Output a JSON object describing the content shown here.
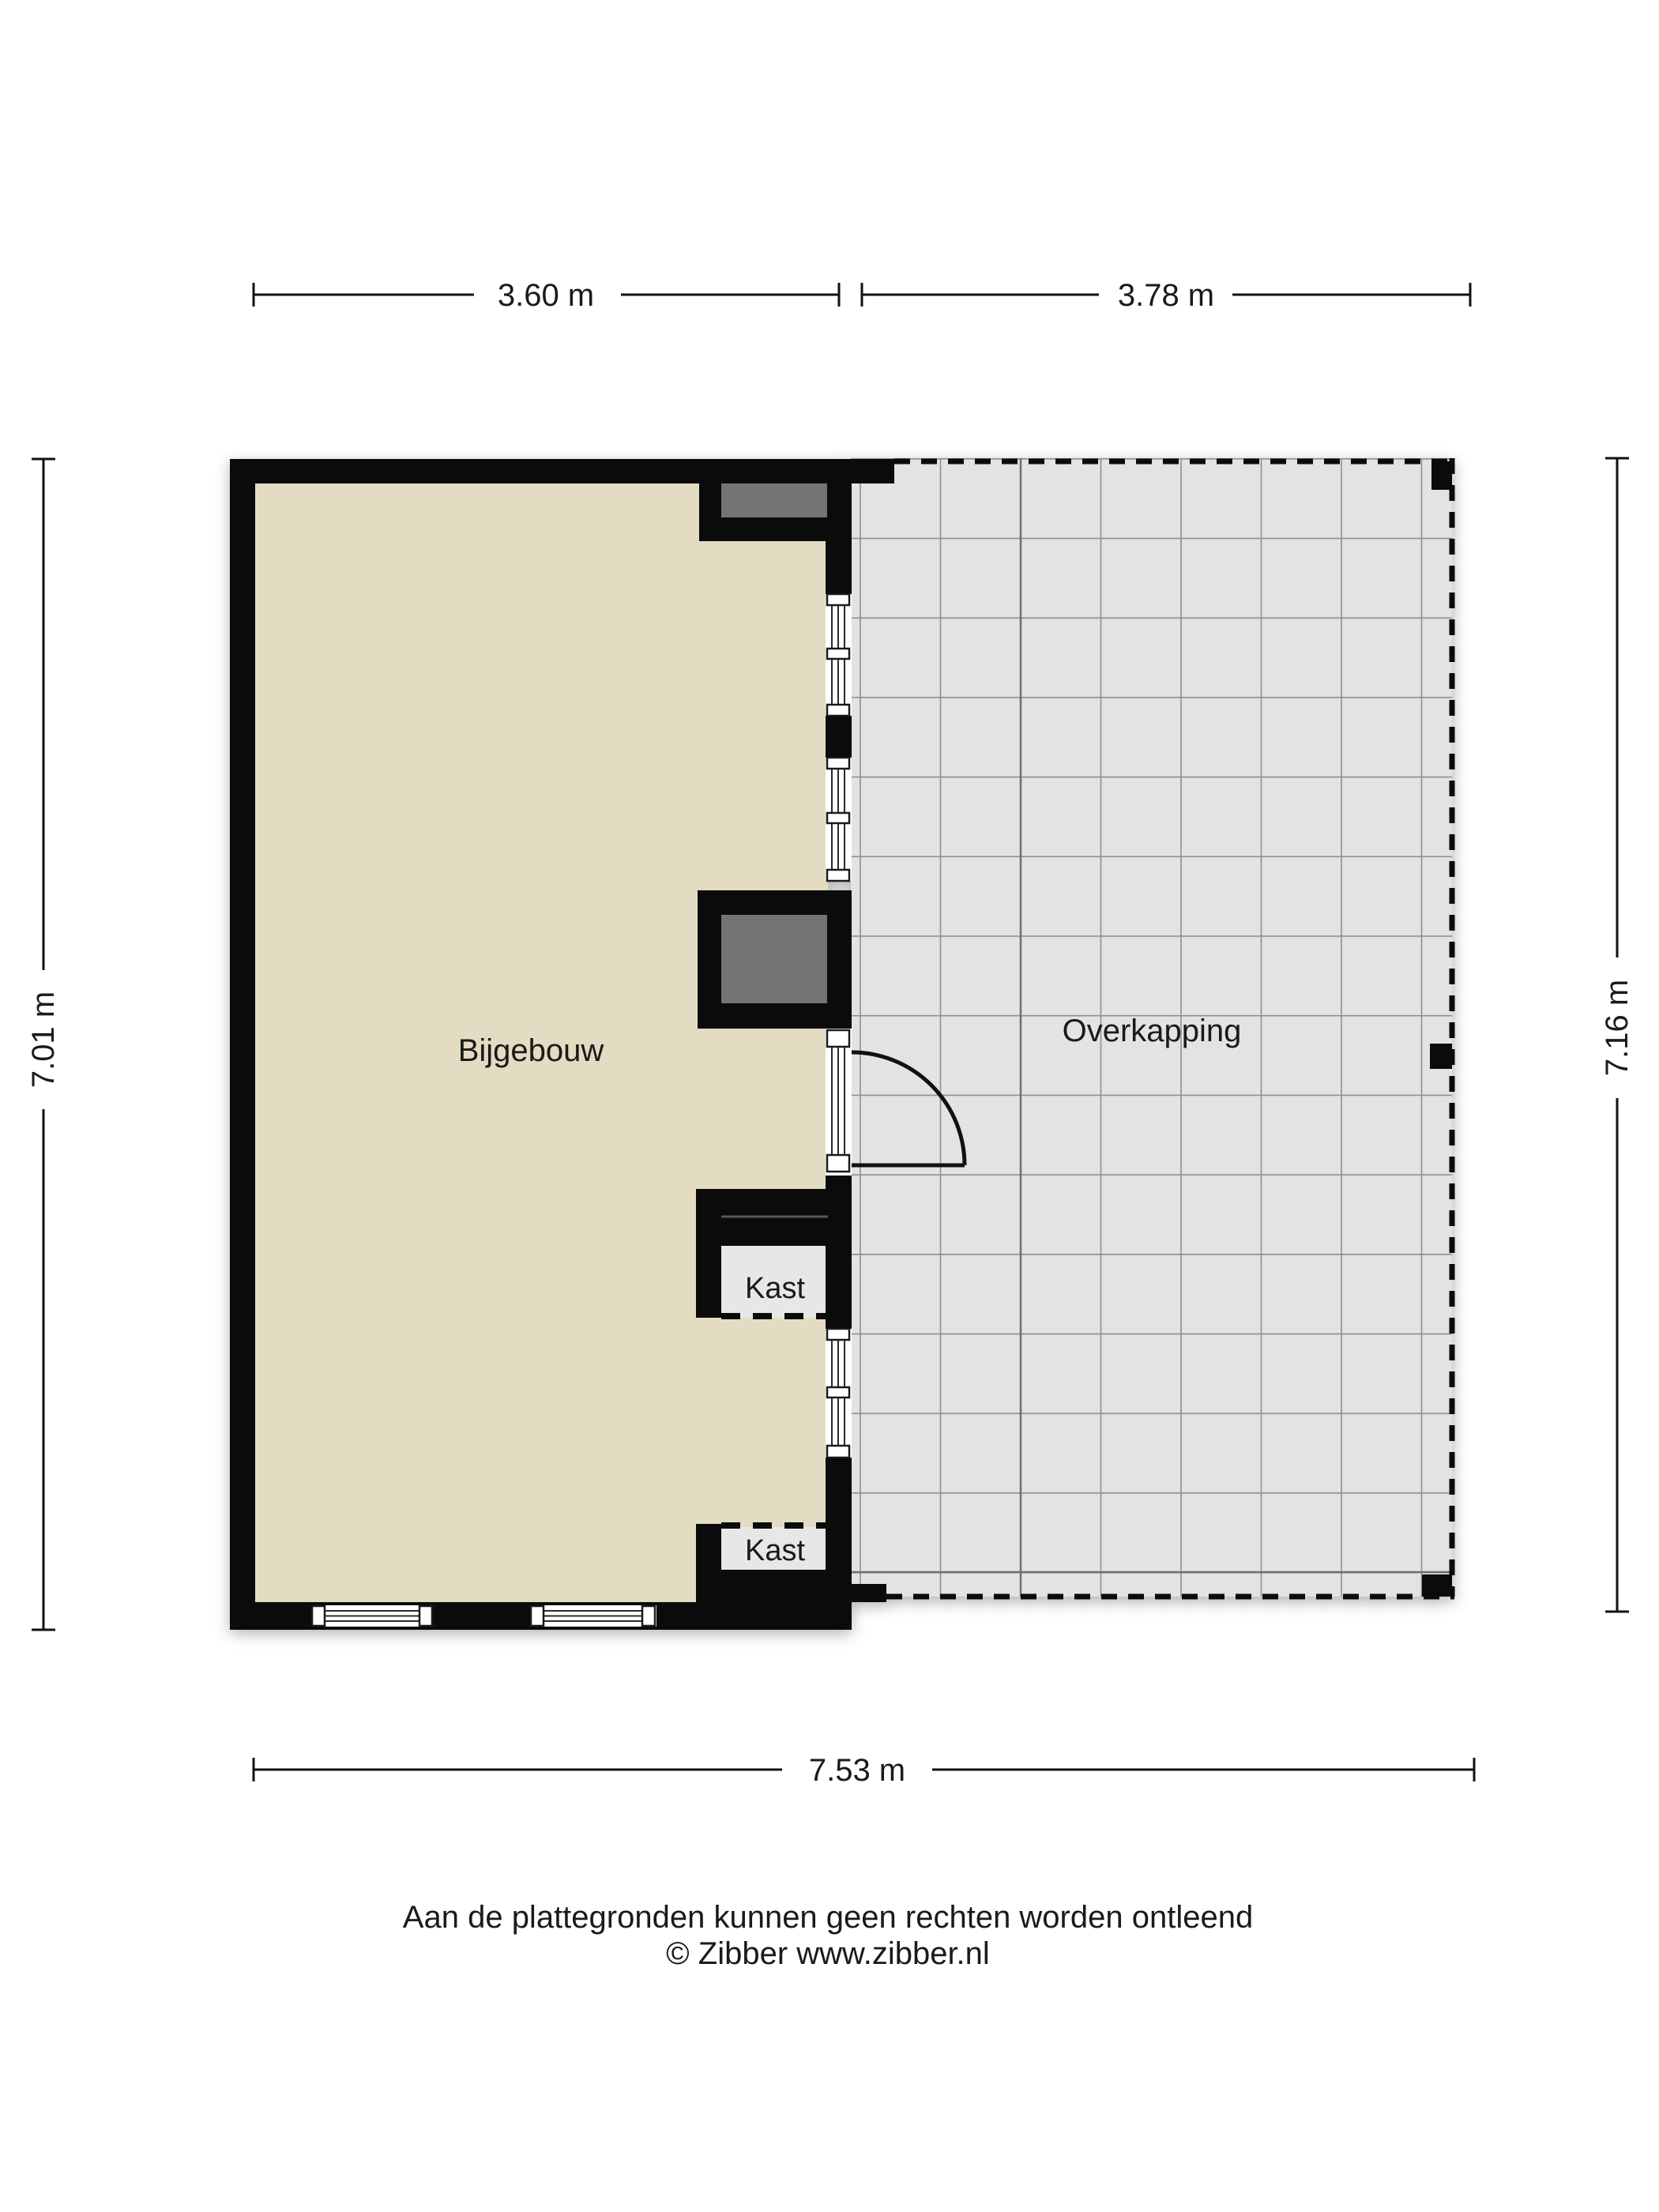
{
  "plan": {
    "rooms": {
      "bijgebouw": "Bijgebouw",
      "overkapping": "Overkapping"
    },
    "closets": {
      "kast1": "Kast",
      "kast2": "Kast"
    },
    "dimensions": {
      "top_left": "3.60 m",
      "top_right": "3.78 m",
      "side_left": "7.01 m",
      "side_right": "7.16 m",
      "bottom": "7.53 m"
    }
  },
  "footer": {
    "disclaimer": "Aan de plattegronden kunnen geen rechten worden ontleend",
    "copyright": "© Zibber www.zibber.nl"
  },
  "colors": {
    "wall": "#0b0b0b",
    "floor_beige": "#e3dcc2",
    "floor_canopy": "#e3e3e2",
    "grid_line": "#8f8f8f",
    "grid_line_dark": "#6f6f6f",
    "box_gray": "#747474",
    "closet_floor": "#e7e7e7",
    "text": "#1a1a1a",
    "dim_line": "#111111",
    "window_white": "#ffffff"
  }
}
